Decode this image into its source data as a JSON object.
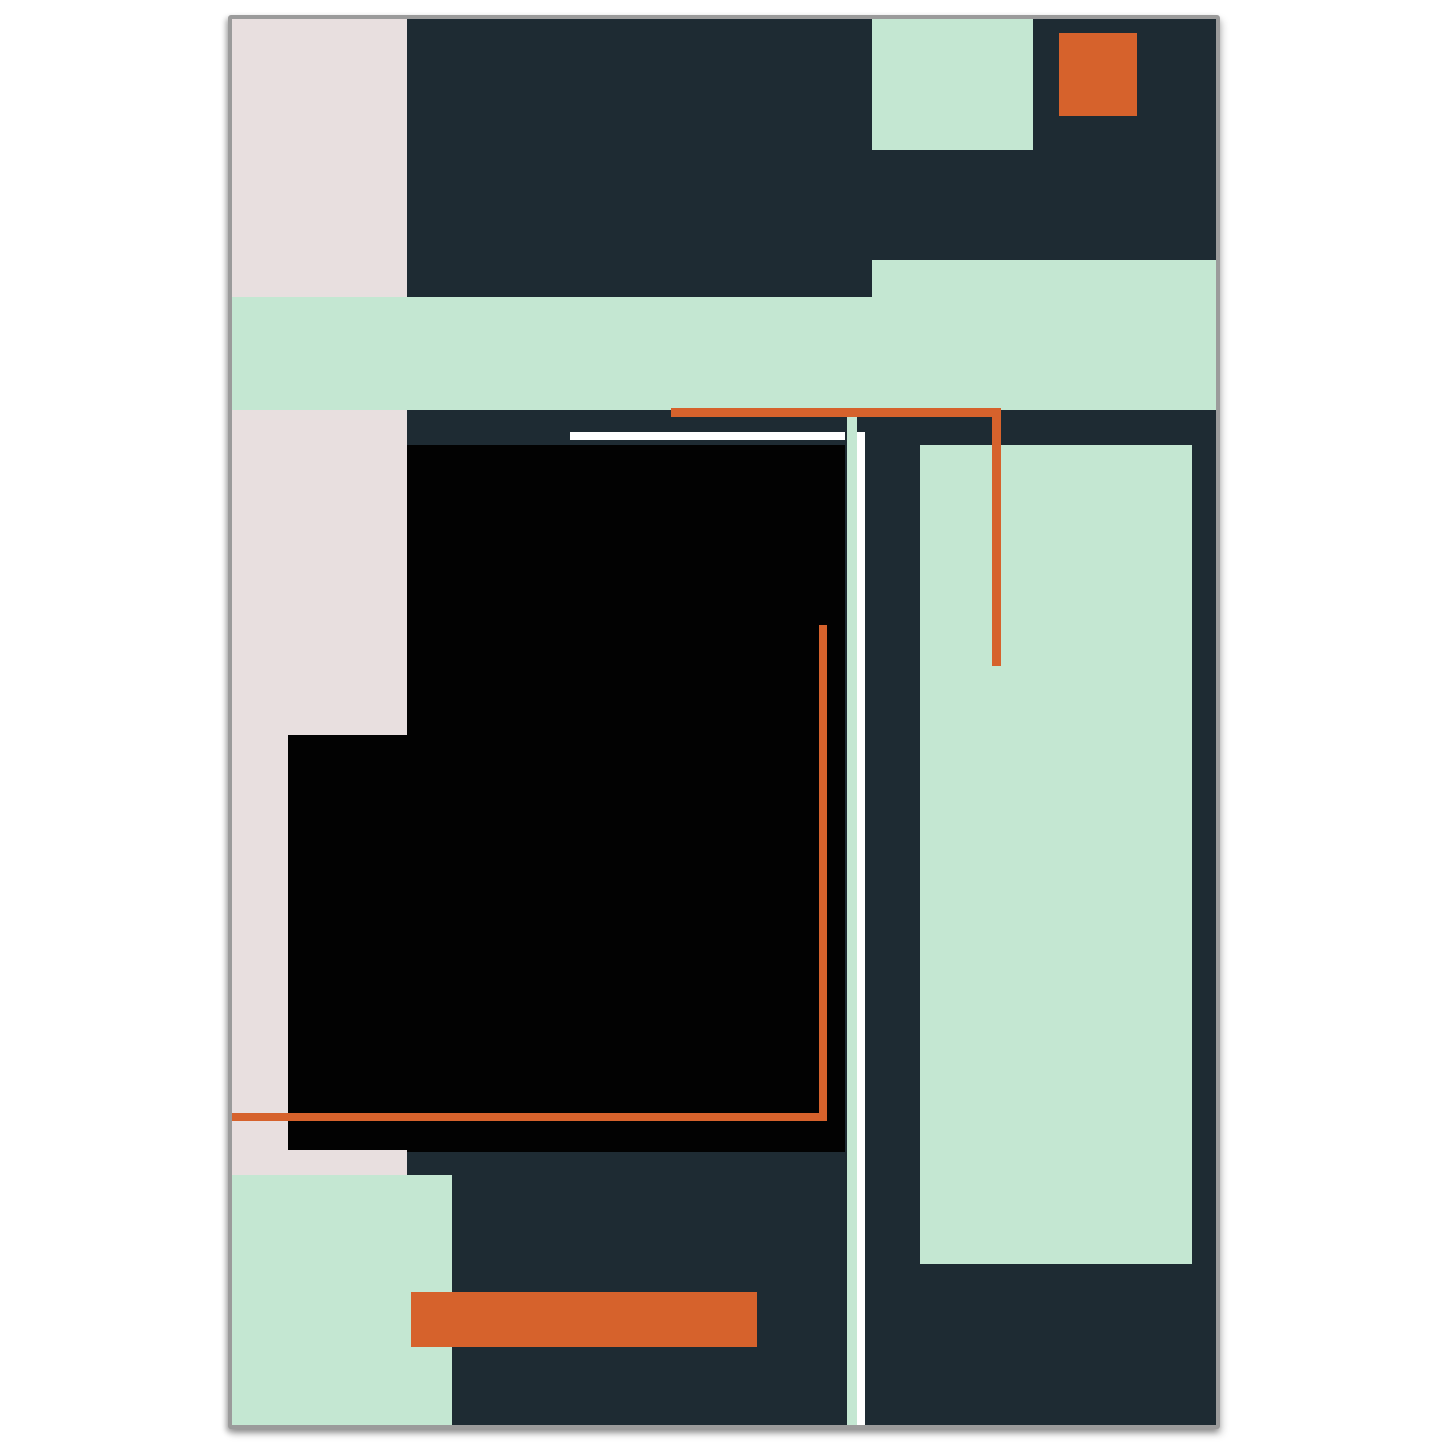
{
  "artwork": {
    "kind": "abstract-geometric-poster",
    "page_background": "#ffffff",
    "frame": {
      "x": 228,
      "y": 15,
      "width": 992,
      "height": 1414,
      "border_color": "#9b9b9b",
      "border_width": 4,
      "base_color": "#1e2b33"
    },
    "palette": {
      "navy": "#1e2b33",
      "mint": "#c4e7d2",
      "pink": "#e8dfdf",
      "orange": "#d6622c",
      "black": "#020202",
      "white": "#ffffff"
    },
    "shapes": [
      {
        "name": "pink-column",
        "color": "pink",
        "x": 0,
        "y": 0,
        "w": 175,
        "h": 716
      },
      {
        "name": "pink-column-narrow",
        "color": "pink",
        "x": 0,
        "y": 716,
        "w": 56,
        "h": 415
      },
      {
        "name": "pink-step",
        "color": "pink",
        "x": 0,
        "y": 1131,
        "w": 175,
        "h": 25
      },
      {
        "name": "black-field-main",
        "color": "black",
        "x": 175,
        "y": 426,
        "w": 438,
        "h": 707
      },
      {
        "name": "black-field-left",
        "color": "black",
        "x": 56,
        "y": 716,
        "w": 119,
        "h": 415
      },
      {
        "name": "mint-band",
        "color": "mint",
        "x": 0,
        "y": 278,
        "w": 945,
        "h": 113
      },
      {
        "name": "mint-band-raised",
        "color": "mint",
        "x": 640,
        "y": 241,
        "w": 537,
        "h": 150
      },
      {
        "name": "mint-rect-top",
        "color": "mint",
        "x": 640,
        "y": 0,
        "w": 161,
        "h": 131
      },
      {
        "name": "orange-square-top",
        "color": "orange",
        "x": 827,
        "y": 14,
        "w": 78,
        "h": 83
      },
      {
        "name": "mint-panel-right",
        "color": "mint",
        "x": 688,
        "y": 426,
        "w": 272,
        "h": 819
      },
      {
        "name": "mint-square-bottom",
        "color": "mint",
        "x": 0,
        "y": 1156,
        "w": 220,
        "h": 252
      },
      {
        "name": "mint-stripe-vertical",
        "color": "mint",
        "x": 615,
        "y": 391,
        "w": 10,
        "h": 1016
      },
      {
        "name": "white-stripe-vertical",
        "color": "white",
        "x": 625,
        "y": 413,
        "w": 8,
        "h": 994
      },
      {
        "name": "white-line-horizontal",
        "color": "white",
        "x": 338,
        "y": 413,
        "w": 275,
        "h": 8
      },
      {
        "name": "orange-line-horizontal",
        "color": "orange",
        "x": 439,
        "y": 389,
        "w": 330,
        "h": 9
      },
      {
        "name": "orange-line-vertical",
        "color": "orange",
        "x": 760,
        "y": 389,
        "w": 9,
        "h": 258
      },
      {
        "name": "orange-thin-line-vertical",
        "color": "orange",
        "x": 587,
        "y": 606,
        "w": 8,
        "h": 496
      },
      {
        "name": "orange-thin-line-horizontal",
        "color": "orange",
        "x": 0,
        "y": 1094,
        "w": 595,
        "h": 8
      },
      {
        "name": "orange-bar-bottom",
        "color": "orange",
        "x": 179,
        "y": 1273,
        "w": 346,
        "h": 55
      }
    ]
  }
}
